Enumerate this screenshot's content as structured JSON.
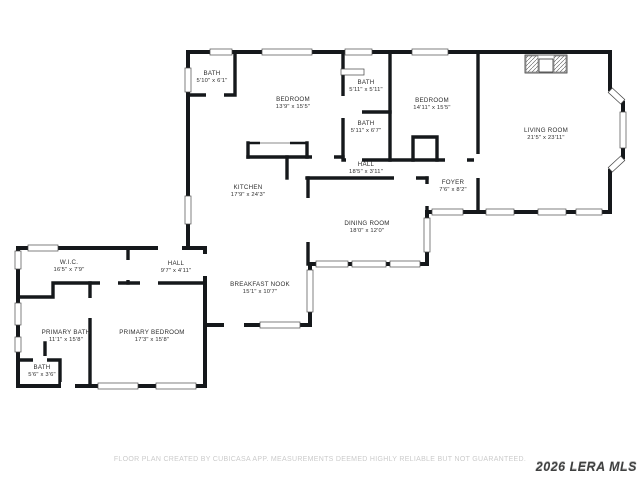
{
  "page": {
    "background": "#ffffff"
  },
  "colors": {
    "wall": "#15181b",
    "label": "#2e2e2e",
    "disclaimer": "#cbcbcb",
    "watermark": "#3f4040"
  },
  "rooms": [
    {
      "id": "bath-1",
      "name": "BATH",
      "dims": "5'10\" x 6'1\"",
      "x": 212,
      "y": 77
    },
    {
      "id": "bedroom-1",
      "name": "BEDROOM",
      "dims": "13'9\" x 15'5\"",
      "x": 293,
      "y": 103
    },
    {
      "id": "bath-2",
      "name": "BATH",
      "dims": "5'11\" x 5'11\"",
      "x": 366,
      "y": 86
    },
    {
      "id": "bath-3",
      "name": "BATH",
      "dims": "5'11\" x 6'7\"",
      "x": 366,
      "y": 127
    },
    {
      "id": "bedroom-2",
      "name": "BEDROOM",
      "dims": "14'11\" x 15'5\"",
      "x": 432,
      "y": 104
    },
    {
      "id": "living-room",
      "name": "LIVING ROOM",
      "dims": "21'5\" x 23'11\"",
      "x": 546,
      "y": 134
    },
    {
      "id": "kitchen",
      "name": "KITCHEN",
      "dims": "17'9\" x 24'3\"",
      "x": 248,
      "y": 191
    },
    {
      "id": "hall-upper",
      "name": "HALL",
      "dims": "18'5\" x 3'11\"",
      "x": 366,
      "y": 168
    },
    {
      "id": "foyer",
      "name": "FOYER",
      "dims": "7'6\" x 8'2\"",
      "x": 453,
      "y": 186
    },
    {
      "id": "dining-room",
      "name": "DINING ROOM",
      "dims": "18'0\" x 12'0\"",
      "x": 367,
      "y": 227
    },
    {
      "id": "breakfast-nook",
      "name": "BREAKFAST NOOK",
      "dims": "15'1\" x 10'7\"",
      "x": 260,
      "y": 288
    },
    {
      "id": "wic",
      "name": "W.I.C.",
      "dims": "16'5\" x 7'9\"",
      "x": 69,
      "y": 266
    },
    {
      "id": "hall-lower",
      "name": "HALL",
      "dims": "9'7\" x 4'11\"",
      "x": 176,
      "y": 267
    },
    {
      "id": "primary-bath",
      "name": "PRIMARY BATH",
      "dims": "11'1\" x 15'8\"",
      "x": 66,
      "y": 336
    },
    {
      "id": "primary-bedroom",
      "name": "PRIMARY BEDROOM",
      "dims": "17'3\" x 15'8\"",
      "x": 152,
      "y": 336
    },
    {
      "id": "bath-4",
      "name": "BATH",
      "dims": "5'6\" x 3'6\"",
      "x": 42,
      "y": 371
    }
  ],
  "footer": {
    "disclaimer": "FLOOR PLAN CREATED BY CUBICASA APP. MEASUREMENTS DEEMED HIGHLY RELIABLE BUT NOT GUARANTEED.",
    "watermark": "2026 LERA MLS"
  }
}
